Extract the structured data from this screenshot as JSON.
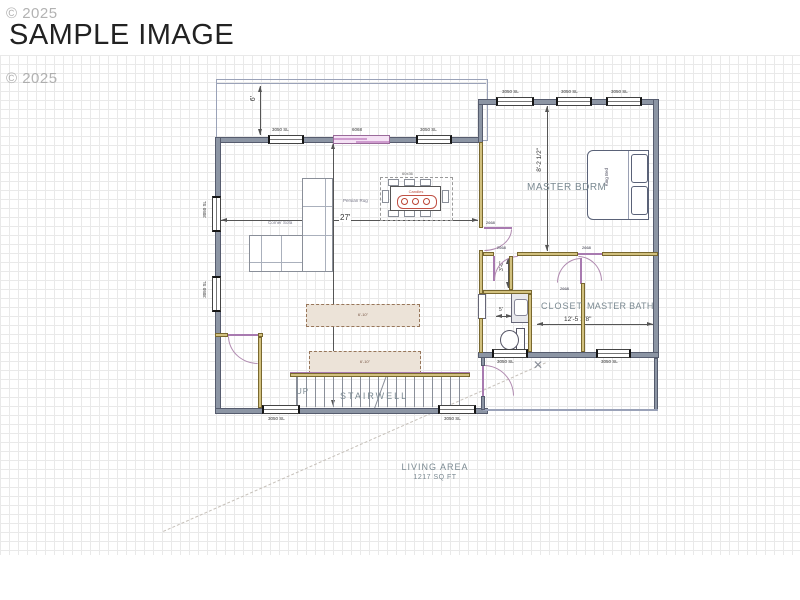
{
  "title": "SAMPLE IMAGE",
  "watermark": {
    "top": "© 2025",
    "mid": "© 2025"
  },
  "rooms": {
    "master_bdrm": "MASTER BDRM",
    "closet": "CLOSET",
    "master_bath": "MASTER BATH",
    "stairwell": "STAIRWELL",
    "up": "UP",
    "living_label": "LIVING AREA",
    "living_sqft": "1217 SQ FT"
  },
  "dims": {
    "deck_depth": "6'",
    "living_width": "27'",
    "living_depth": "24'",
    "master_depth": "8'-2 1/2\"",
    "bath_width": "12'-5 1/8\"",
    "wc_depth": "3'-6\"",
    "vanity_width": "5'",
    "vanity_size": "60\""
  },
  "windows": {
    "top_left": "3050 SL",
    "top_slider": "6068",
    "top_right": "3050 SL",
    "master_1": "3050 SL",
    "master_2": "3050 SL",
    "master_3": "3050 SL",
    "left_1": "3050 SL",
    "left_2": "3050 SL",
    "bottom_1": "3050 SL",
    "bottom_2": "3050 SL",
    "bath_1": "3050 SL",
    "bath_2": "3050 SL"
  },
  "doors": {
    "master": "2668",
    "closet": "2668",
    "bath": "2668",
    "divider": "2668"
  },
  "furniture": {
    "sofa": "Corner Sofa",
    "rug": "Persian Rug",
    "bed": "King Bed",
    "table": "60x36",
    "table_decor": "Candles",
    "island_1": "6'-10\"",
    "island_2": "6'-10\""
  },
  "colors": {
    "exterior_wall": "#8c95a4",
    "interior_wall": "#d2c17f",
    "door_swing": "#a87ab0",
    "room_label": "#7b8a92",
    "dimension": "#444444",
    "decor_red": "#bb4433"
  }
}
